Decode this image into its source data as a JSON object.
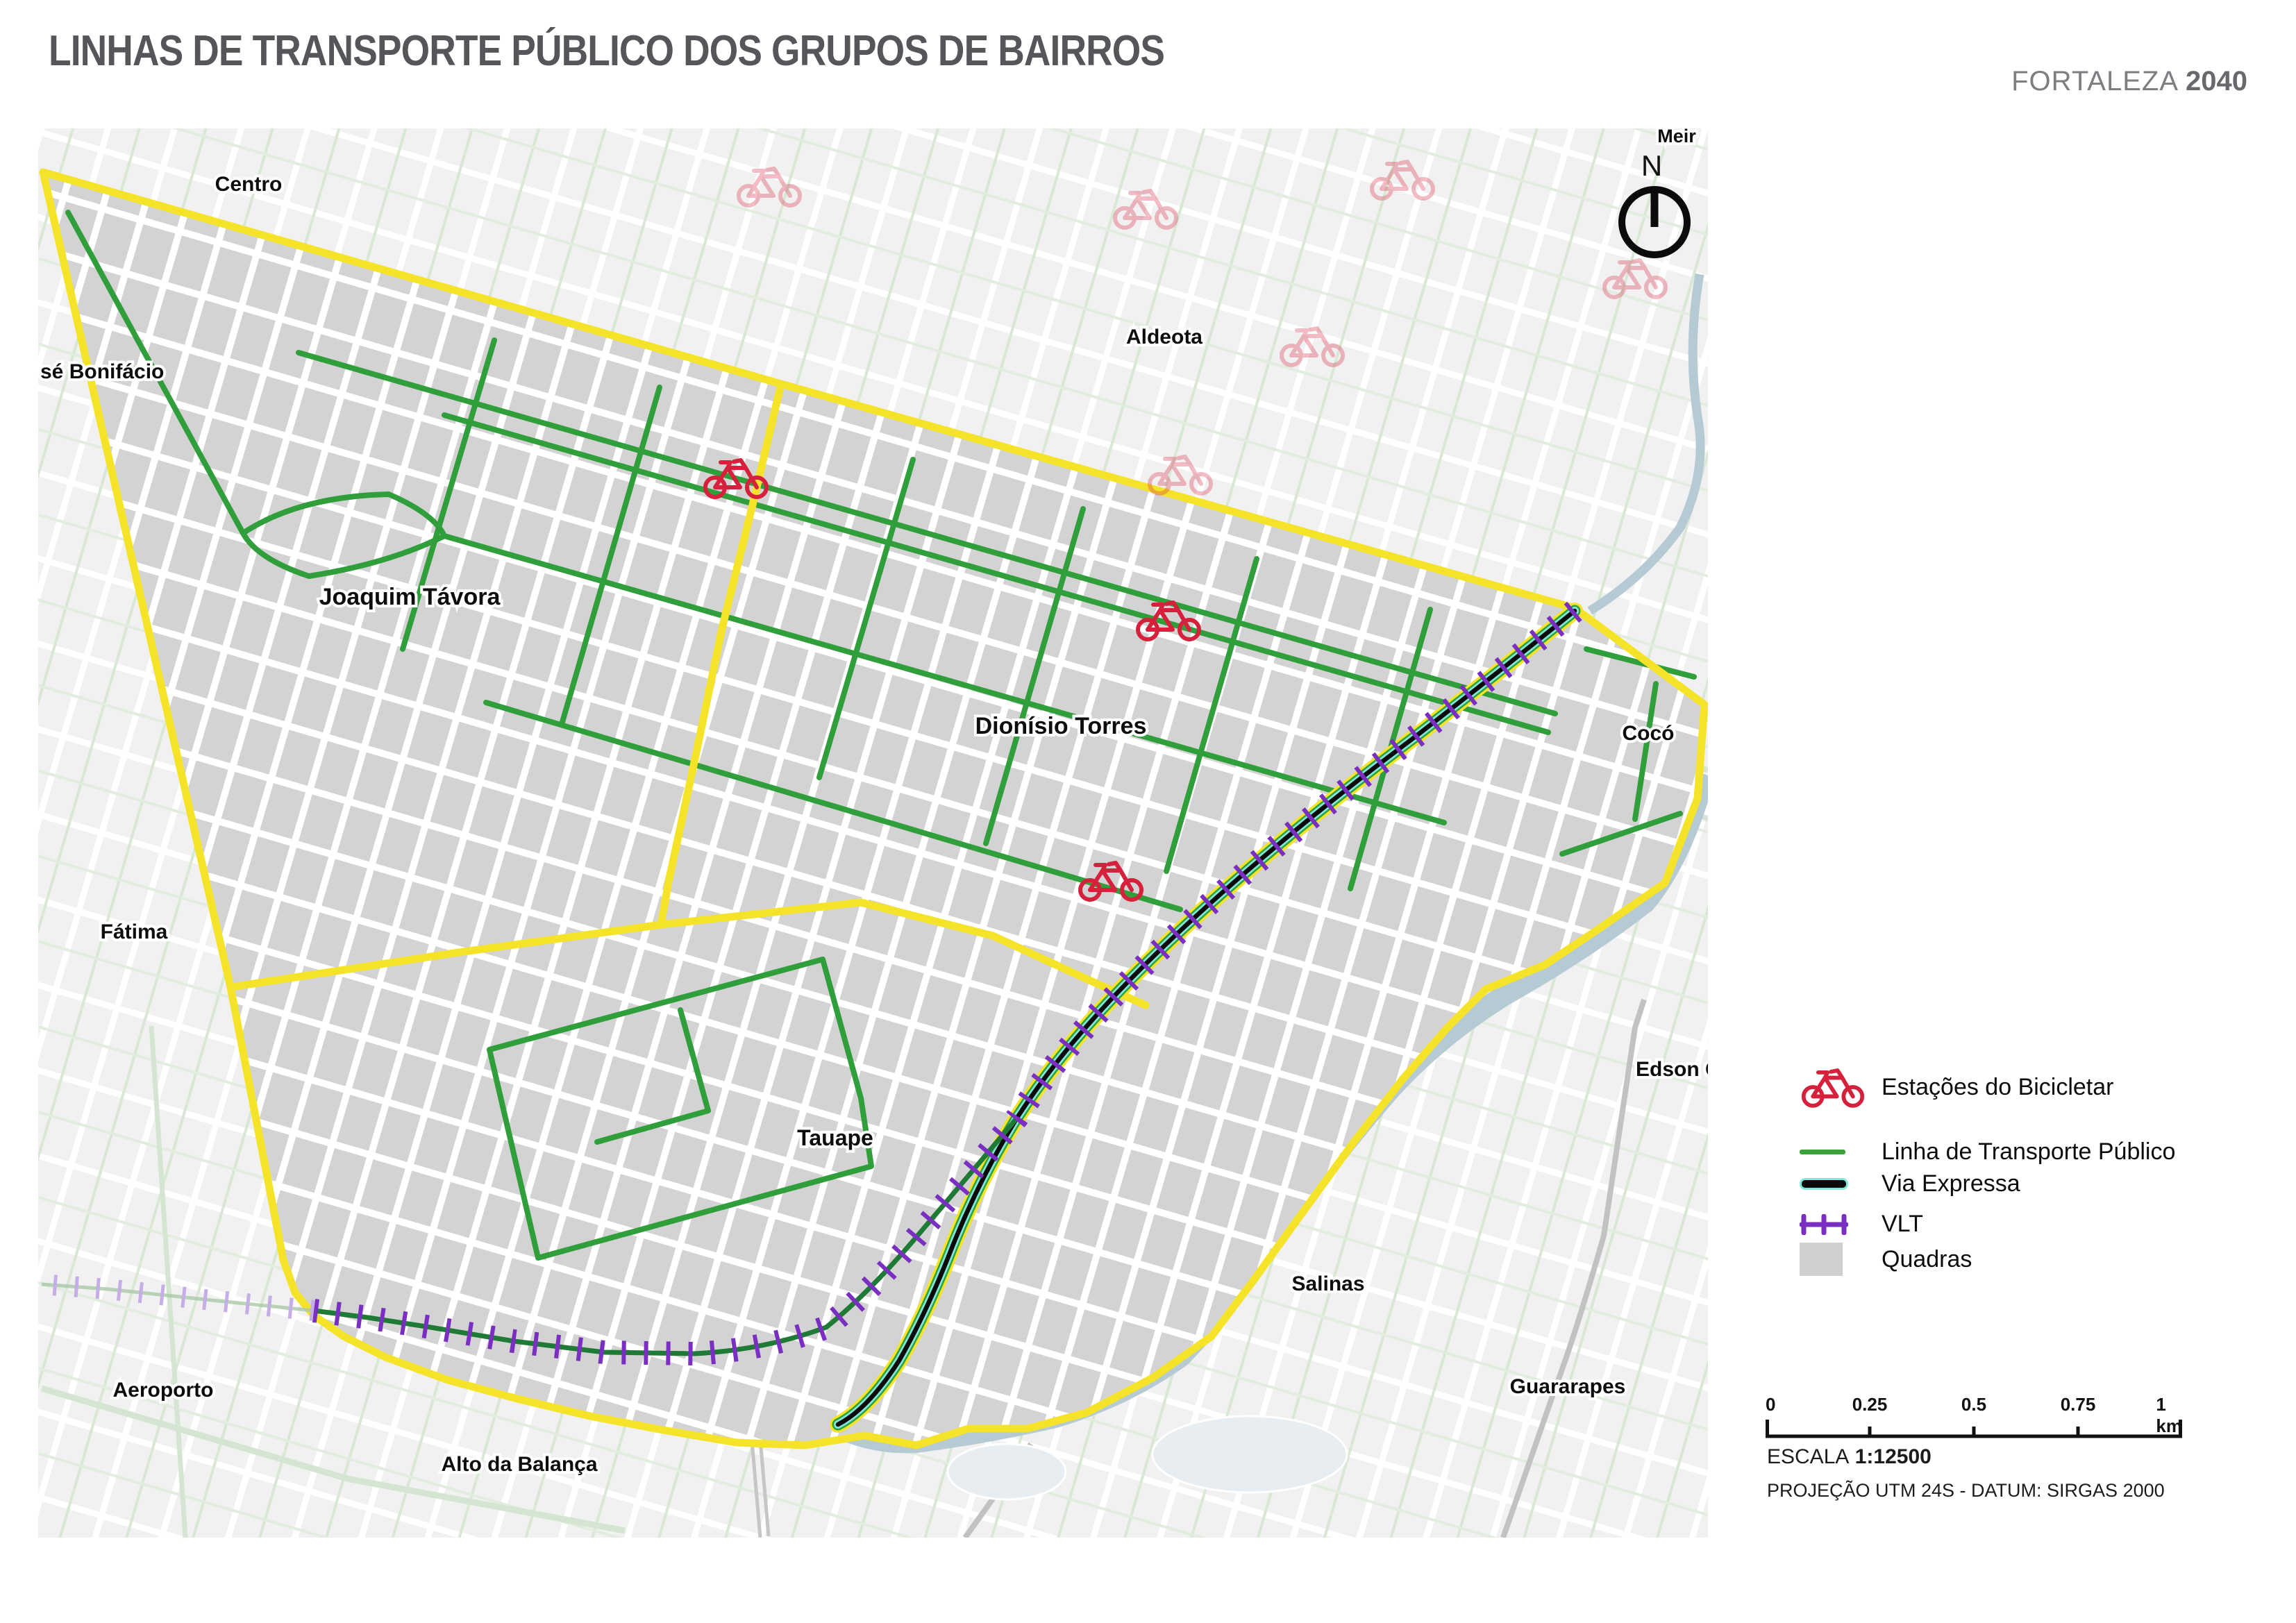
{
  "header": {
    "title": "LINHAS DE TRANSPORTE PÚBLICO DOS GRUPOS DE BAIRROS",
    "brand": {
      "name": "FORTALEZA",
      "year": "2040"
    }
  },
  "map": {
    "north_indicator": "N",
    "labels": {
      "centro": "Centro",
      "meireles_partial": "Meir",
      "jose_bonifacio_partial": "sé Bonifácio",
      "aldeota": "Aldeota",
      "joaquim_tavora": "Joaquim Távora",
      "dionisio_torres": "Dionísio Torres",
      "coco": "Cocó",
      "fatima": "Fátima",
      "tauape": "Tauape",
      "edson_queiroz_partial": "Edson Quei",
      "salinas": "Salinas",
      "guararapes": "Guararapes",
      "aeroporto": "Aeroporto",
      "alto_da_balanca": "Alto da Balança"
    },
    "bike_stations_active": 3,
    "bike_stations_faded": 6
  },
  "legend": {
    "items": [
      {
        "key": "bike-station",
        "label": "Estações do Bicicletar"
      },
      {
        "key": "transport-line",
        "label": "Linha de Transporte Público"
      },
      {
        "key": "via-expressa",
        "label": "Via Expressa"
      },
      {
        "key": "vlt",
        "label": "VLT"
      },
      {
        "key": "quadras",
        "label": "Quadras"
      }
    ]
  },
  "scalebar": {
    "labels": [
      "0",
      "0.25",
      "0.5",
      "0.75",
      "1 km"
    ]
  },
  "footer": {
    "escala_label": "ESCALA",
    "escala_value": "1:12500",
    "projection": "PROJEÇÃO UTM 24S - DATUM: SIRGAS 2000"
  },
  "colors": {
    "boundary": "#f5e32a",
    "transport_line": "#2f9e3b",
    "via_expressa_core": "#0b0b0b",
    "via_expressa_glow": "#7fe9d9",
    "vlt": "#7a2fc0",
    "quadras": "#d3d3d3",
    "bike_station": "#d6213c",
    "water": "#b6cad4",
    "title_text": "#55565a"
  }
}
